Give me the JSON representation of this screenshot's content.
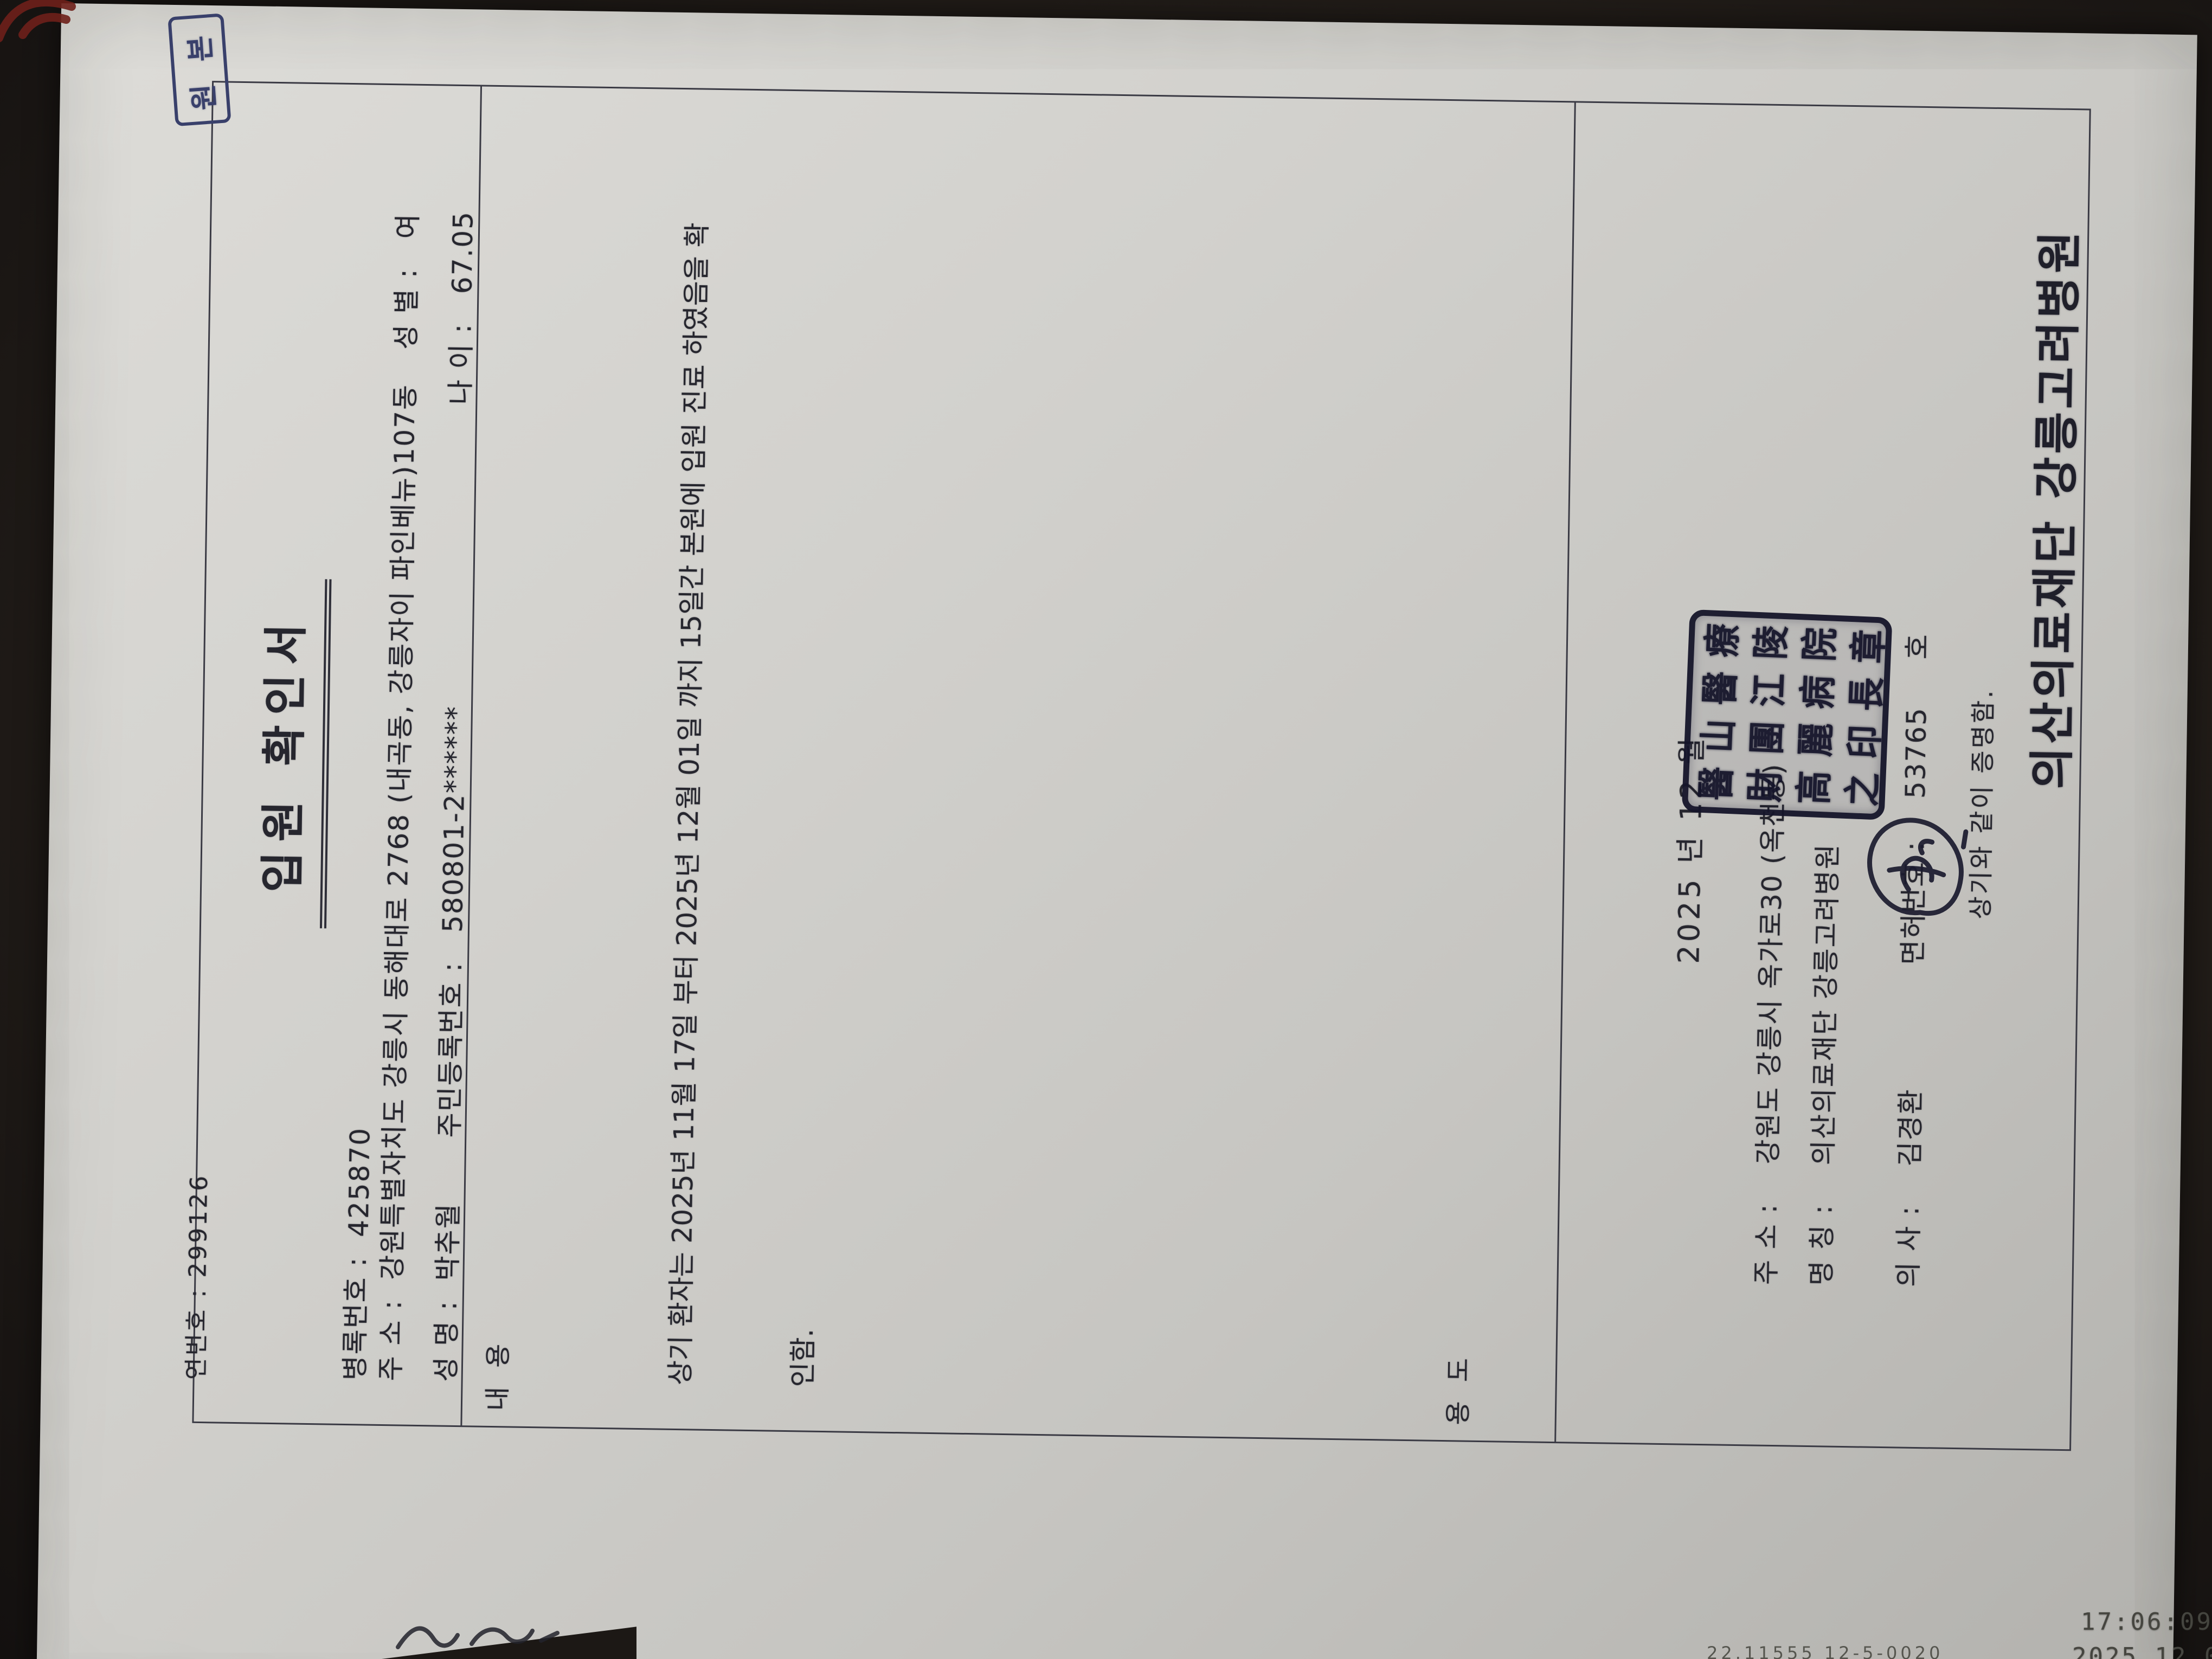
{
  "photo": {
    "timestamp_time": "17:06:09",
    "timestamp_date": "2025.12.02",
    "bottom_edge_text": "22.11555 12-5-0020"
  },
  "document": {
    "serial": "연번호 :  299126",
    "copy_stamp": "원 본",
    "title": "입원 확인서",
    "fields": {
      "record_no_label": "병록번호 :",
      "record_no": "425870",
      "address_label": "주  소 :",
      "address": "강원특별자치도 강릉시 동해대로 2768 (내곡동, 강릉자이 파인베뉴)107동",
      "sex_label": "성 별 :",
      "sex": "여",
      "name_label": "성  명 :",
      "name": "박추월",
      "rrn_label": "주민등록번호 :",
      "rrn": "580801-2******",
      "age_label": "나  이 :",
      "age": "67.05"
    },
    "content_label": "내  용",
    "content_line1": "상기 환자는 2025년 11월 17일 부터 2025년 12월 01일 까지 15일간 본원에 입원 진료 하였음을 확",
    "content_line2": "인함.",
    "purpose_label": "용  도",
    "issue": {
      "date": "2025 년    12 월",
      "addr_label": "주 소 :",
      "addr": "강원도 강릉시 옥가로30 (옥천동)",
      "org_label": "명 칭 :",
      "org": "의산의료재단 강릉고려병원",
      "doctor_label": "의 사 :",
      "doctor": "김경환",
      "license_label": "면허번호 :",
      "license_no": "53765",
      "license_suffix": "호",
      "certify": "상기와 같이 증명함.",
      "hospital_big": "의산의료재단  강릉고려병원"
    },
    "seal_chars": [
      "醫",
      "山",
      "醫",
      "療",
      "財",
      "團",
      "江",
      "陵",
      "高",
      "麗",
      "病",
      "院",
      "之",
      "印",
      "長",
      "章"
    ]
  },
  "colors": {
    "paper": "#cfcecb",
    "ink": "#26262e",
    "stamp_blue": "#39406b",
    "seal_navy": "#15152a",
    "background": "#211c18"
  }
}
